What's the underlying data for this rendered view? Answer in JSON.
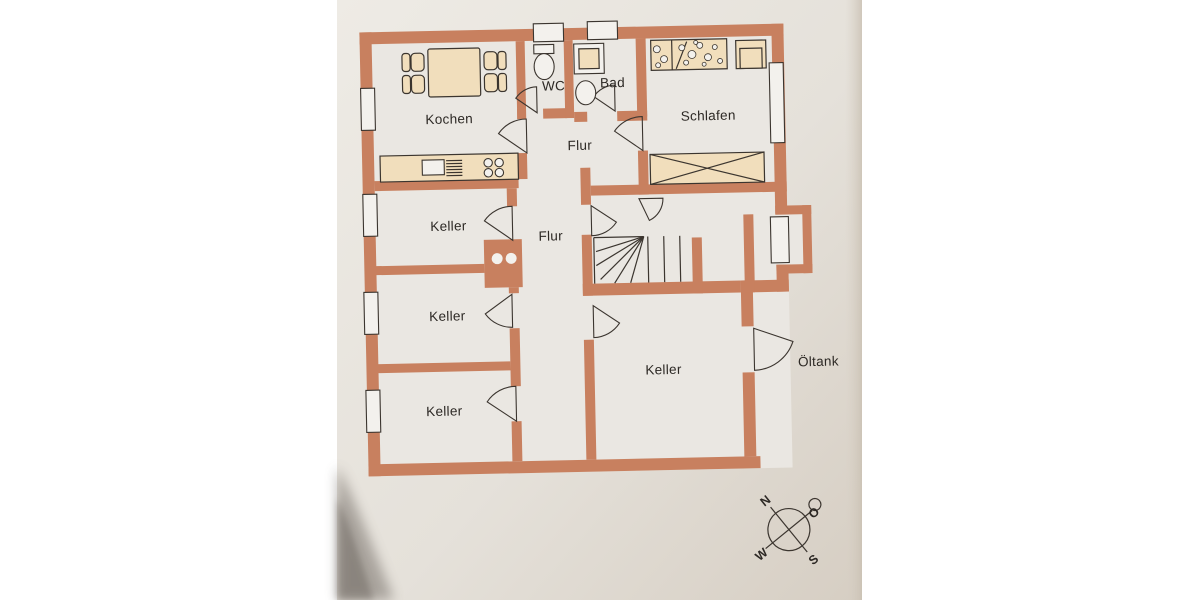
{
  "labels": {
    "kochen": "Kochen",
    "wc": "WC",
    "bad": "Bad",
    "schlafen": "Schlafen",
    "flur_top": "Flur",
    "flur_mid": "Flur",
    "keller_1": "Keller",
    "keller_2": "Keller",
    "keller_3": "Keller",
    "keller_4": "Keller",
    "oeltank": "Öltank"
  },
  "compass": {
    "north": "N",
    "east": "O",
    "south": "S",
    "west": "W"
  },
  "colors": {
    "background": "#ffffff",
    "paper": "#ece9e3",
    "paper-edge": "#d8d0c5",
    "floor": "#eae7e2",
    "wall": "#c8805f",
    "furniture": "#f1debc",
    "line": "#3b352f",
    "text": "#2c2824",
    "window": "#f3f1ed",
    "shadow": "#554e47"
  }
}
